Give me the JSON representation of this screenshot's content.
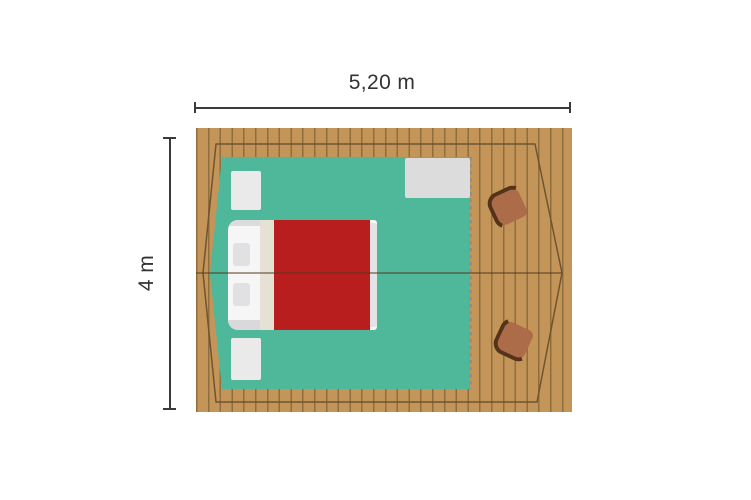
{
  "floorplan": {
    "dimensions": {
      "width_label": "5,20 m",
      "height_label": "4 m"
    },
    "colors": {
      "background": "#ffffff",
      "deck": "#c49559",
      "deck_line": "#8f6d3d",
      "outline": "#6f5430",
      "canvas_floor": "#4fb79a",
      "entrance_dash": "#87938f",
      "mat": "#eaeaea",
      "entrance_mat": "#dcdcdd",
      "bed_sheet": "#f6f6f7",
      "bed_fold": "#e6e1d5",
      "bed_duvet": "#b81e1e",
      "bed_foot": "#e4e4e6",
      "pillow": "#e1e1e3",
      "chair_body": "#ad6c49",
      "chair_back": "#53341b",
      "dimension_line": "#3a3a3a",
      "label_text": "#333333",
      "ridge_line": "rgba(84,58,30,0.5)"
    }
  }
}
